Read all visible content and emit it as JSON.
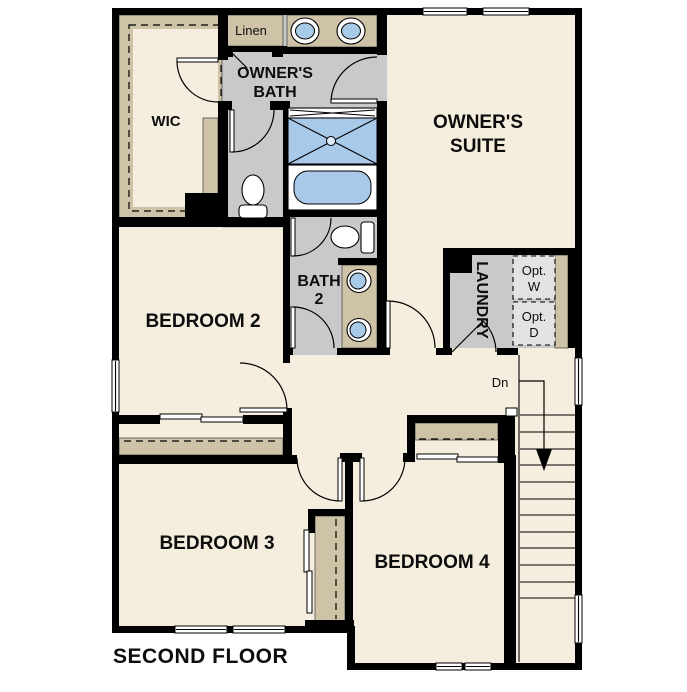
{
  "plan": {
    "title": "SECOND FLOOR",
    "rooms": {
      "owners_suite": {
        "line1": "OWNER'S",
        "line2": "SUITE"
      },
      "owners_bath": {
        "line1": "OWNER'S",
        "line2": "BATH"
      },
      "wic": {
        "label": "WIC"
      },
      "linen": {
        "label": "Linen"
      },
      "bedroom2": {
        "label": "BEDROOM 2"
      },
      "bath2": {
        "line1": "BATH",
        "line2": "2"
      },
      "laundry": {
        "label": "LAUNDRY"
      },
      "bedroom3": {
        "label": "BEDROOM 3"
      },
      "bedroom4": {
        "label": "BEDROOM 4"
      },
      "opt_washer": {
        "line1": "Opt.",
        "line2": "W"
      },
      "opt_dryer": {
        "line1": "Opt.",
        "line2": "D"
      }
    },
    "stairs": {
      "down_label": "Dn"
    },
    "colors": {
      "floor_cream": "#f5eddd",
      "wet_gray": "#c9c9c9",
      "casework_tan": "#cfc3a7",
      "fixture_blue": "#a9c9e9",
      "wall_black": "#000000",
      "opt_box_gray": "#e3e3e3",
      "background_white": "#ffffff"
    }
  }
}
